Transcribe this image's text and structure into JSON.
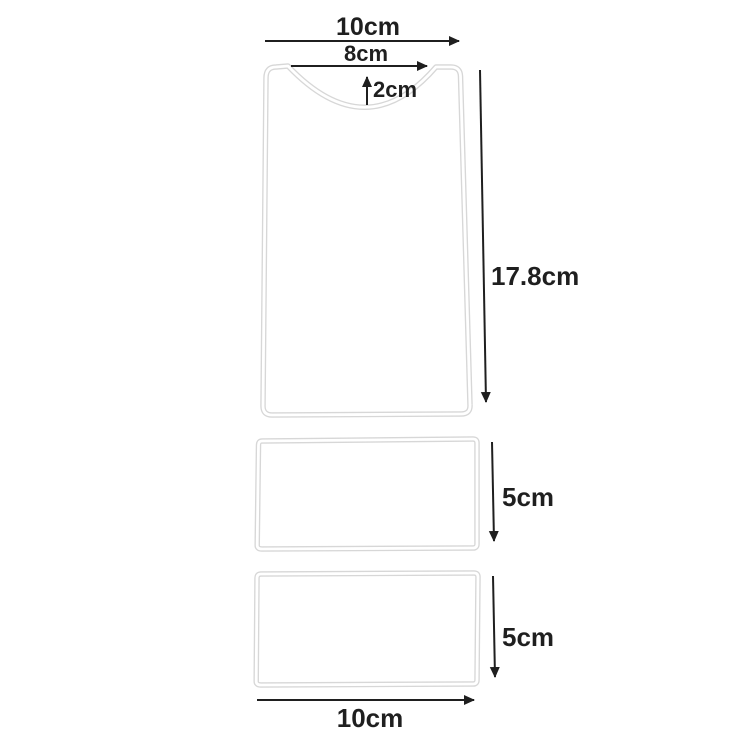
{
  "diagram": {
    "labels": {
      "top_width": "10cm",
      "notch_width": "8cm",
      "notch_depth": "2cm",
      "body_height": "17.8cm",
      "middle_strip_height": "5cm",
      "bottom_strip_height": "5cm",
      "base_width": "10cm"
    },
    "colors": {
      "dimension_line": "#1f1f1f",
      "label_text": "#1f1f1f",
      "wire_outline": "#d7d7d7",
      "wire_core": "#ffffff",
      "background": "#ffffff"
    }
  }
}
